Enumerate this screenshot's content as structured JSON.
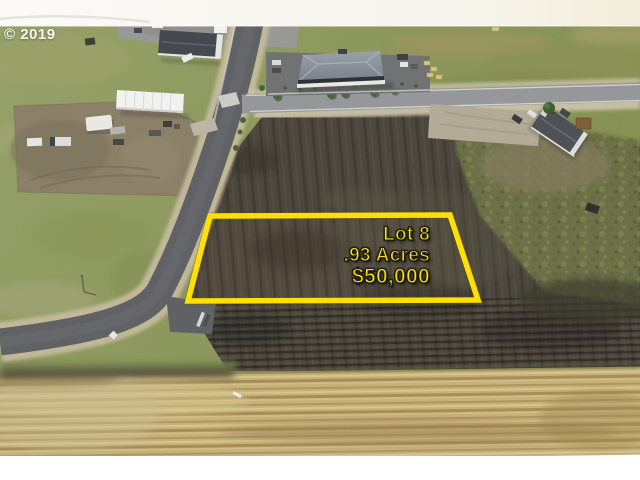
{
  "photo": {
    "watermark": "© 2019",
    "description": "aerial drone photo of a vacant lot for sale beside new streets, commercial buildings, a house, plowed fields and a harvested wheat field"
  },
  "listing": {
    "lot": "Lot 8",
    "acres": ".93 Acres",
    "price": "$50,000"
  },
  "colors": {
    "parcel_outline": "#ffdf05",
    "listing_text": "#ffe20a",
    "watermark_text": "#f7f7f7",
    "grass": "#8d9960",
    "plowed_field": "#49433a",
    "wheat_field": "#c7b17a",
    "asphalt_new": "#5d5f63",
    "asphalt_old": "#94979a",
    "sky_band": "#f8f6f1",
    "bottom_margin": "#ffffff"
  },
  "scene_features": [
    "yellow parcel outline",
    "new paved street with gravel shoulders",
    "east-west street with street trees",
    "commercial building with hip roof",
    "metal shop building with parking lot",
    "white warehouse",
    "rv and truck storage yard",
    "house with dark roof and gravel drive",
    "plowed dark field",
    "scrub pasture",
    "harvested wheat field",
    "hay bales",
    "road barricade at street end"
  ]
}
